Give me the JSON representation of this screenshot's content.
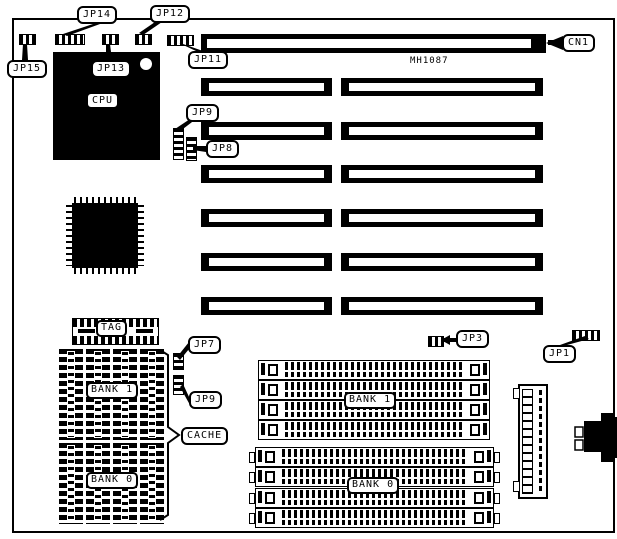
{
  "labels": {
    "jp14": "JP14",
    "jp12": "JP12",
    "jp15": "JP15",
    "jp13": "JP13",
    "jp11": "JP11",
    "cn1": "CN1",
    "jp9_upper": "JP9",
    "jp8": "JP8",
    "jp7": "JP7",
    "jp9_lower": "JP9",
    "jp3": "JP3",
    "jp1": "JP1",
    "cache": "CACHE"
  },
  "components": {
    "model_number": "MH1087",
    "cpu": "CPU",
    "tag": "TAG"
  },
  "banks": {
    "cache_bank1": "BANK 1",
    "cache_bank0": "BANK 0",
    "dram_bank1": "BANK 1",
    "dram_bank0": "BANK 0"
  },
  "colors": {
    "ink": "#000000",
    "paper": "#ffffff"
  }
}
